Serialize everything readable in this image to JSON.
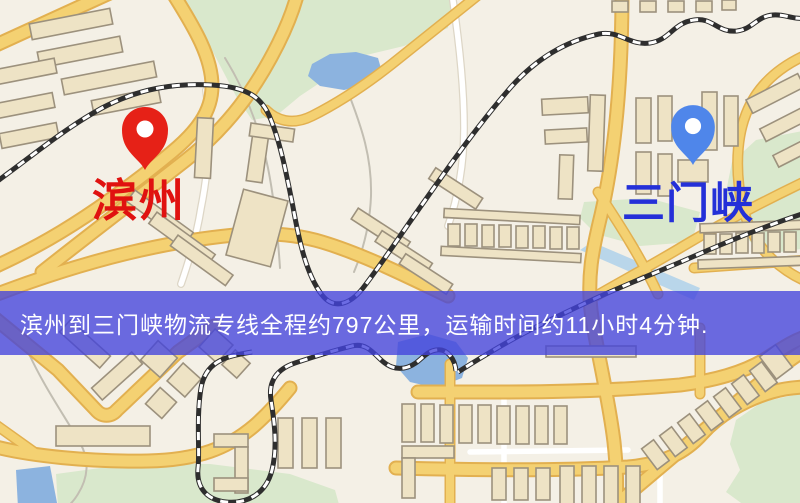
{
  "map": {
    "origin_marker": {
      "label": "滨州",
      "pin_color": "#e62117",
      "label_color": "#e01210"
    },
    "destination_marker": {
      "label": "三门峡",
      "pin_color": "#4f86ea",
      "label_color": "#2430d8"
    },
    "banner": {
      "text": "滨州到三门峡物流专线全程约797公里，运输时间约11小时4分钟.",
      "background_color": "#4242dc",
      "opacity": 0.78,
      "text_color": "#ffffff"
    },
    "route": {
      "from": "滨州",
      "to": "三门峡",
      "distance_km": "797",
      "duration": "11小时4分钟"
    },
    "palette": {
      "map_background": "#f4f0e6",
      "road_major": "#f4d172",
      "road_casing": "#e2b050",
      "road_minor": "#ffffff",
      "building_fill": "#eee3c5",
      "building_stroke": "#9c917d",
      "park_green": "#d9e8cc",
      "water_blue": "#8cb3df",
      "railway_dark": "#2e2e2e"
    }
  }
}
